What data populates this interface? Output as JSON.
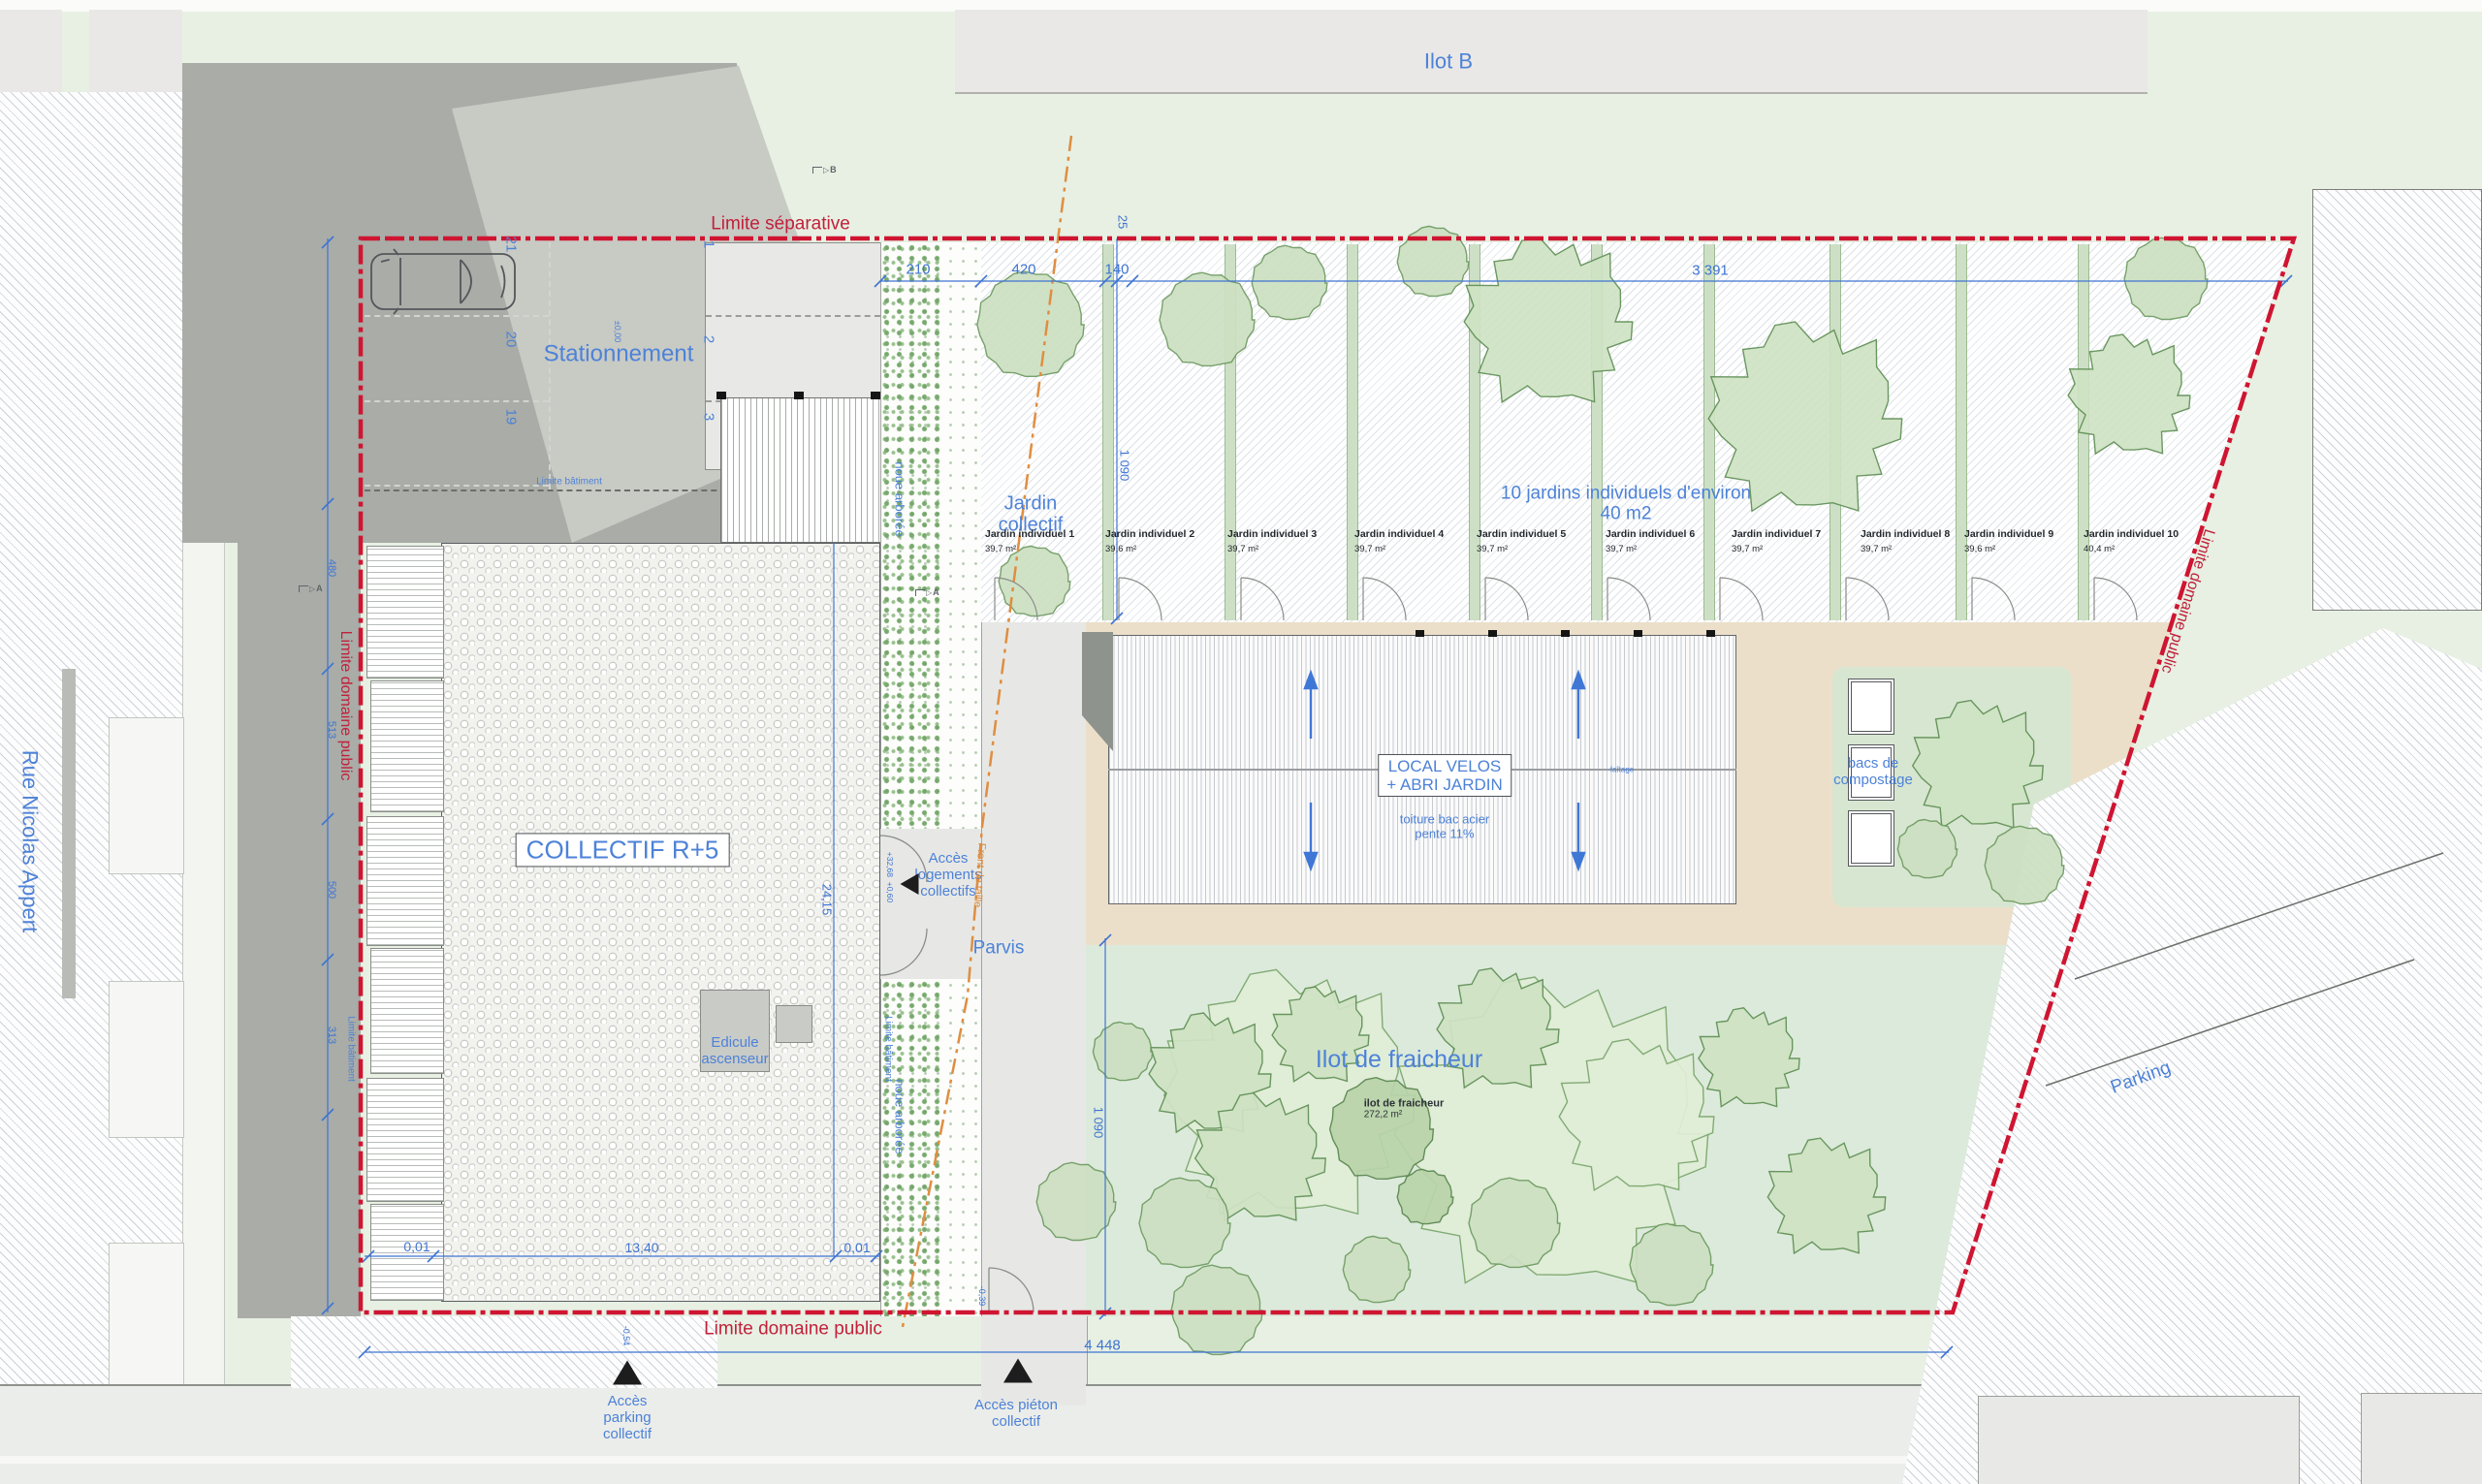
{
  "context": {
    "ilot_b": "Ilot B",
    "rue_nicolas_appert": "Rue Nicolas Appert",
    "parking_est": "Parking"
  },
  "limites": {
    "separative": "Limite séparative",
    "domaine_public": "Limite domaine public",
    "batiment": "Limite bâtiment"
  },
  "stationnement": {
    "label": "Stationnement",
    "niveau": "±0,00",
    "places_gauche": [
      "21",
      "20",
      "19"
    ],
    "places_droite": [
      "1",
      "2",
      "3"
    ]
  },
  "batiment_collectif": {
    "label": "COLLECTIF R+5",
    "edicule_l1": "Edicule",
    "edicule_l2": "ascenseur"
  },
  "acces": {
    "logements_l1": "Accès",
    "logements_l2": "logements",
    "logements_l3": "collectifs",
    "parvis": "Parvis",
    "niveau_entree_l1": "+32,68",
    "niveau_entree_l2": "+0,60",
    "parking_l1": "Accès",
    "parking_l2": "parking",
    "parking_l3": "collectif",
    "pieton_l1": "Accès piéton",
    "pieton_l2": "collectif",
    "niveau_sortie": "-0,54",
    "niveau_pieton": "-0,39"
  },
  "espaces_verts": {
    "noue": "noue arborée",
    "jardin_collectif_l1": "Jardin",
    "jardin_collectif_l2": "collectif",
    "note_l1": "10 jardins individuels d'environ",
    "note_l2": "40 m2",
    "ilot_fraicheur_titre": "Ilot de fraicheur",
    "ilot_fraicheur_l1": "ilot de fraicheur",
    "ilot_fraicheur_l2": "272,2 m²",
    "bacs_l1": "bacs de",
    "bacs_l2": "compostage",
    "plots": [
      {
        "name": "Jardin individuel 1",
        "area": "39,7 m²"
      },
      {
        "name": "Jardin individuel 2",
        "area": "39,6 m²"
      },
      {
        "name": "Jardin individuel 3",
        "area": "39,7 m²"
      },
      {
        "name": "Jardin individuel 4",
        "area": "39,7 m²"
      },
      {
        "name": "Jardin individuel 5",
        "area": "39,7 m²"
      },
      {
        "name": "Jardin individuel 6",
        "area": "39,7 m²"
      },
      {
        "name": "Jardin individuel 7",
        "area": "39,7 m²"
      },
      {
        "name": "Jardin individuel 8",
        "area": "39,7 m²"
      },
      {
        "name": "Jardin individuel 9",
        "area": "39,6 m²"
      },
      {
        "name": "Jardin individuel 10",
        "area": "40,4 m²"
      }
    ]
  },
  "local_velos": {
    "titre_l1": "LOCAL VELOS",
    "titre_l2": "+ ABRI JARDIN",
    "toiture_l1": "toiture bac acier",
    "toiture_l2": "pente 11%",
    "faitage": "faîtage"
  },
  "front_de_taille": "Front de taille",
  "cotes": {
    "haut_1": "210",
    "haut_2": "420",
    "haut_3": "140",
    "haut_4": "3 391",
    "offset_haut": "25",
    "vert_jardins": "1 090",
    "vert_fraicheur": "1 090",
    "bat_profondeur": "24,15",
    "bat_bas_1": "0,01",
    "bat_bas_2": "13,40",
    "bat_bas_3": "0,01",
    "total_bas": "4 448",
    "gauche_1": "480",
    "gauche_2": "513",
    "gauche_3": "500",
    "gauche_4": "313"
  },
  "sections": {
    "a": "A",
    "b": "B"
  }
}
